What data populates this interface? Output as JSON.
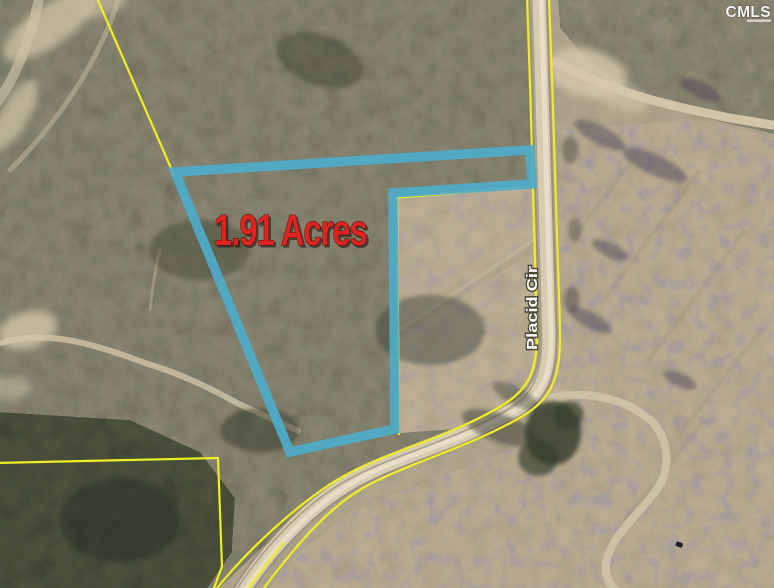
{
  "map": {
    "acreage_label": "1.91 Acres",
    "road_label": "Placid Cir",
    "watermark": "CMLS"
  },
  "colors": {
    "parcel_highlight": "#4EACC9",
    "boundary_line": "#EFEF25",
    "acreage_text": "#DF231E",
    "road_label_text": "#FFFFFF"
  }
}
